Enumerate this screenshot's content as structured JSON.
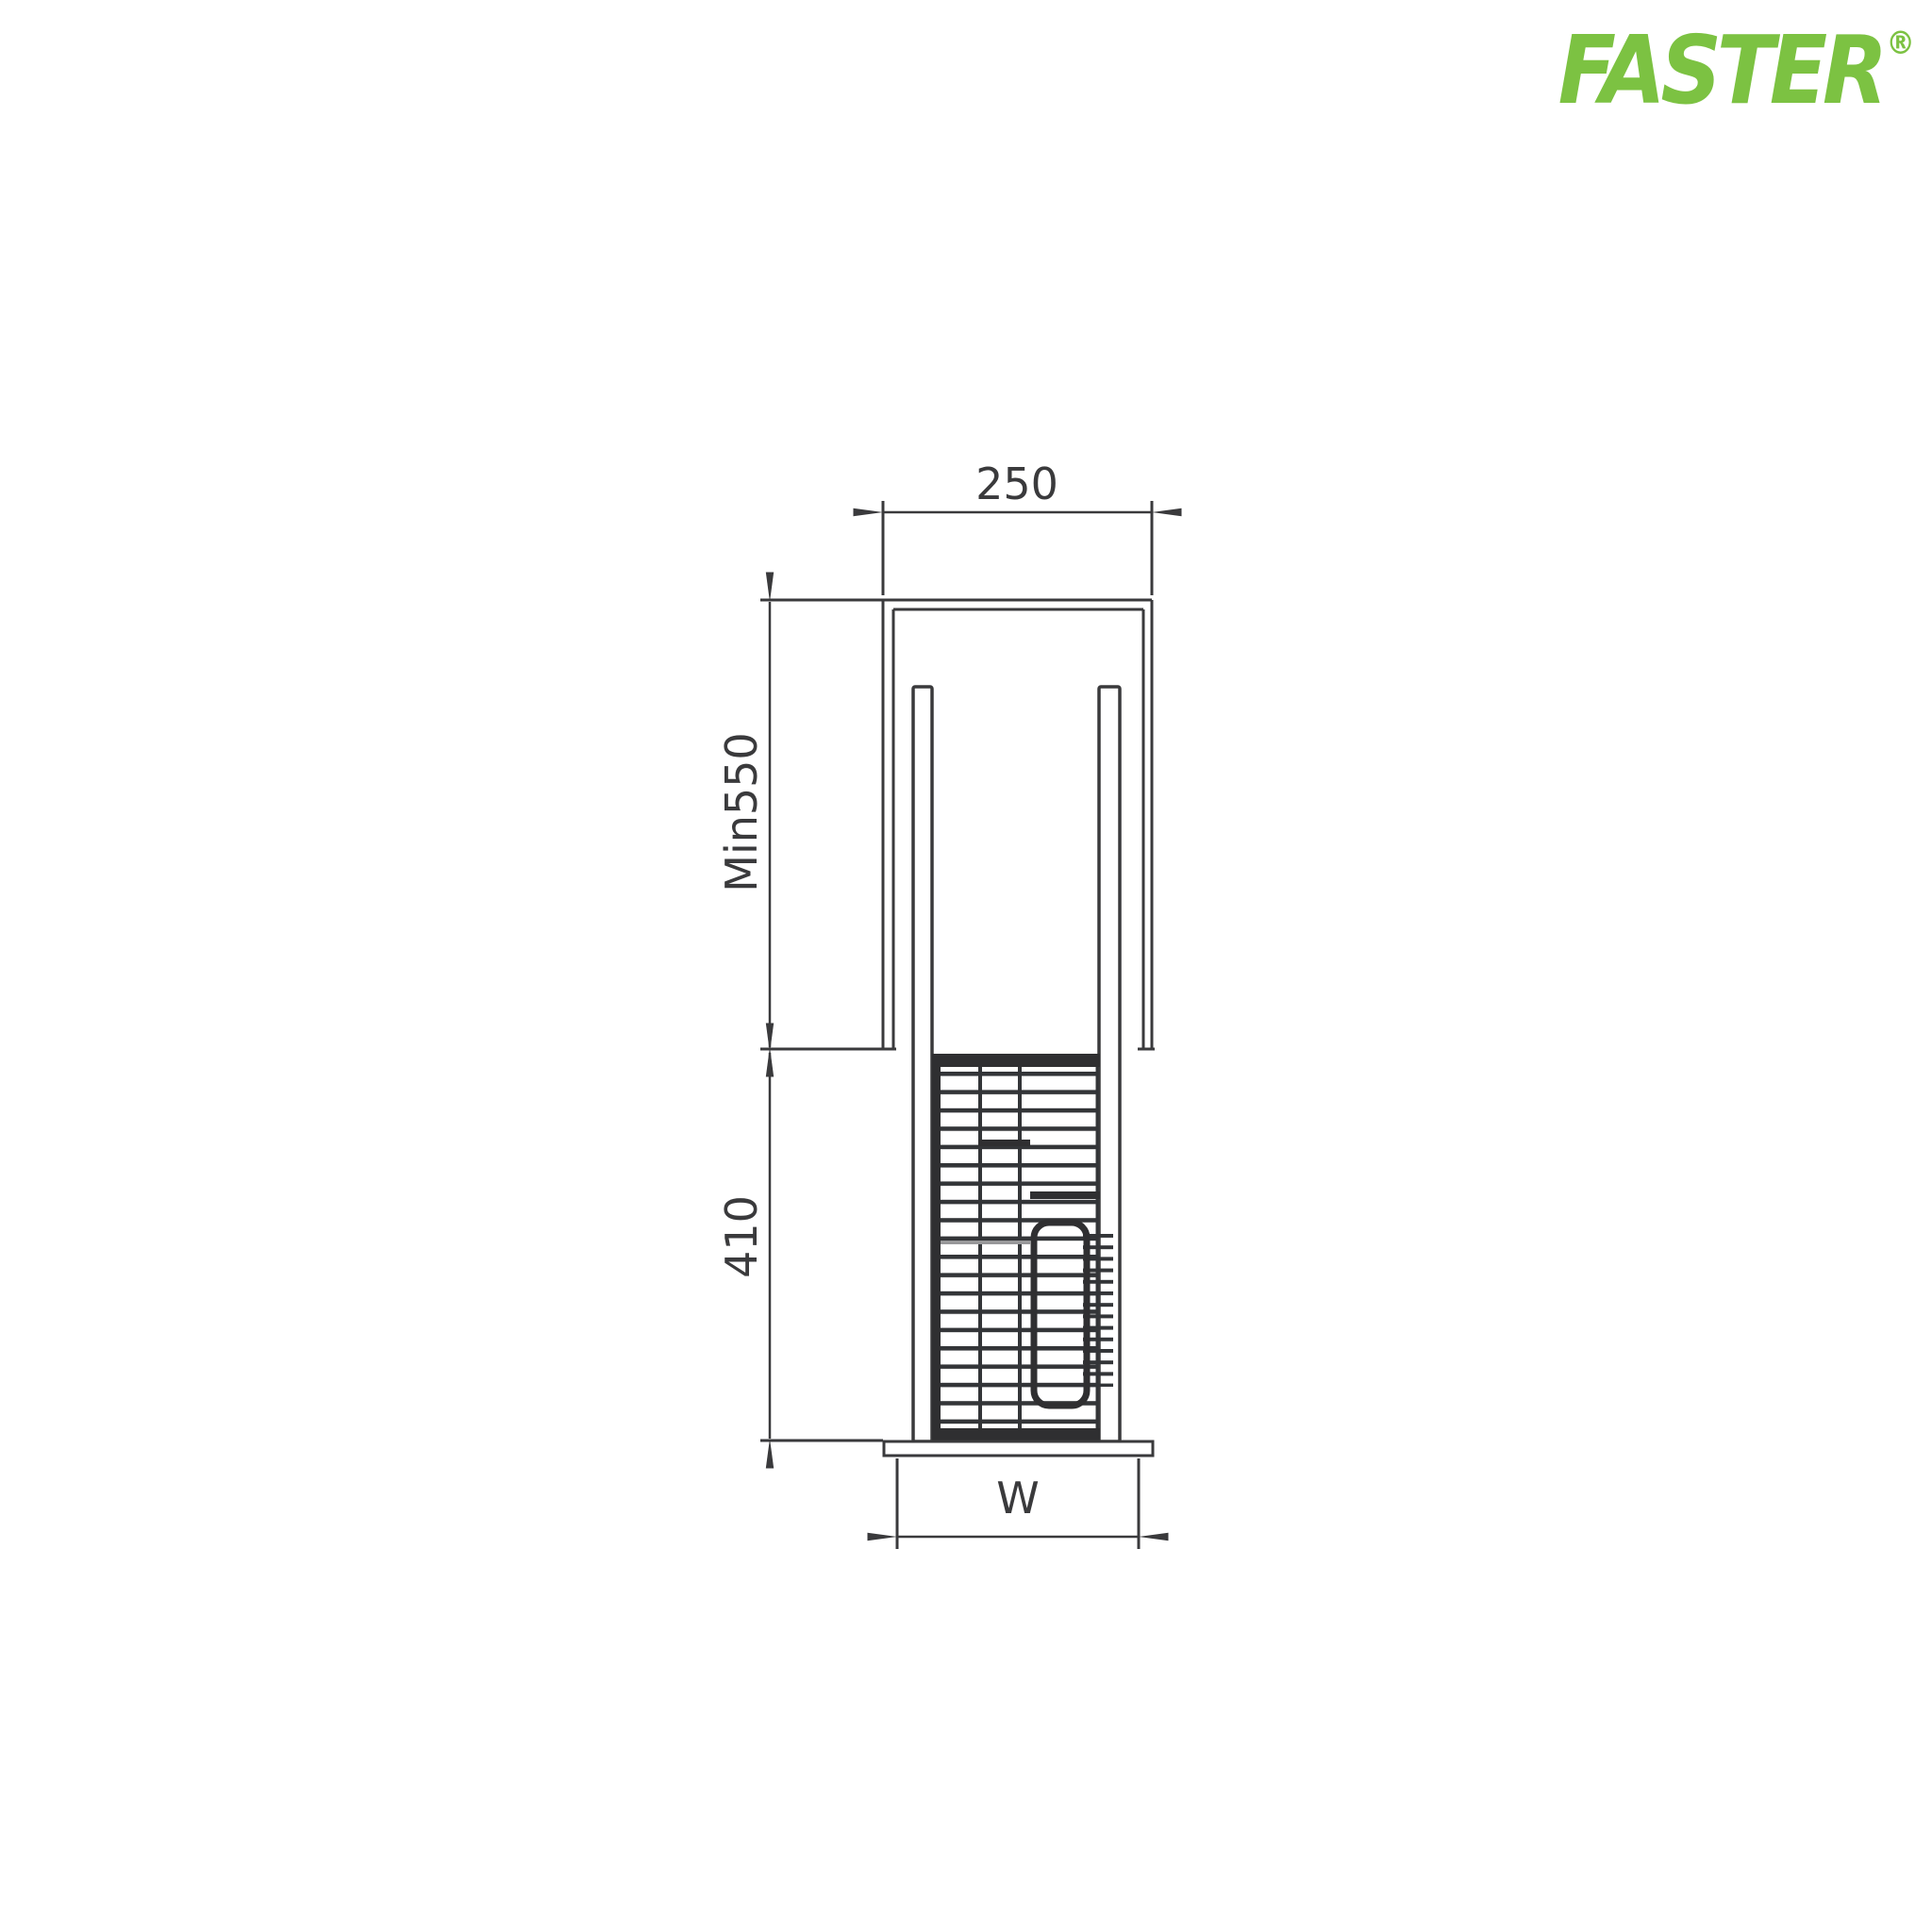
{
  "logo": {
    "brand": "FASTER",
    "registered_mark": "®",
    "brand_color": "#7CC242"
  },
  "drawing": {
    "line_color": "#3A3A3C",
    "dark_fill_color": "#2F2F31",
    "dimensions": {
      "cabinet_width_label": "250",
      "cabinet_min_height_label": "Min550",
      "basket_height_label": "410",
      "base_width_label": "W"
    }
  }
}
